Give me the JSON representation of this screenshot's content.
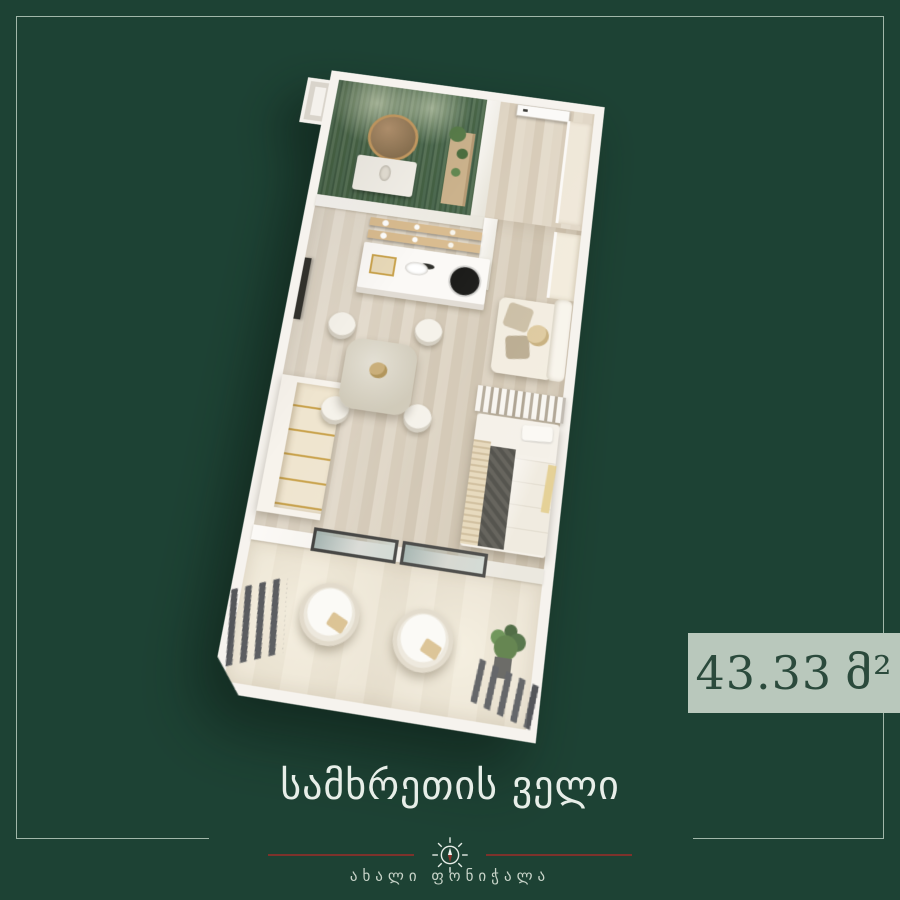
{
  "page": {
    "background_color": "#1d4234",
    "frame_color": "#b9cbbe"
  },
  "area_badge": {
    "value": "43.33",
    "unit": "მ²",
    "bg_color": "#b9c8bc",
    "text_color": "#2b4a3c"
  },
  "footer": {
    "title": "სამხრეთის ველი",
    "subtitle": "ახალი ფონიჭალა",
    "divider_color": "#7d322b",
    "compass_icon": "compass-icon"
  },
  "floor_plan": {
    "view": "3d-top-down-render",
    "rooms": [
      "bathroom",
      "entry-hall",
      "kitchen",
      "living-dining",
      "bedroom",
      "balcony"
    ],
    "palette": {
      "walls": "#f6f3ee",
      "wood_floor": "#d8cdbb",
      "bathroom_tile_green": "#567455",
      "balcony_floor": "#e9e1d1",
      "bed_blanket": "#56544d",
      "gold_accent": "#c9a24b"
    }
  }
}
